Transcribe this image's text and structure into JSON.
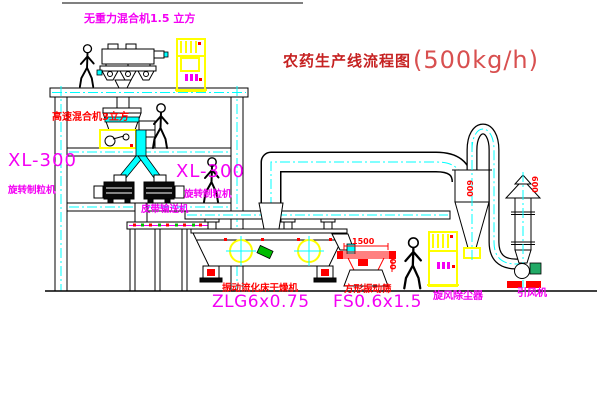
{
  "title": {
    "name": "农药生产线流程图",
    "capacity": "(500kg/h)"
  },
  "equipment_labels": {
    "gravity_free_mixer": "无重力混合机1.5 立方",
    "high_speed_mixer": "高速混合机3立方",
    "granulator_left_model": "XL-300",
    "granulator_left_name": "旋转制粒机",
    "granulator_right_model": "XL-300",
    "granulator_right_name": "旋转制粒机",
    "belt_conveyor": "皮带输送机",
    "fluid_bed_dryer_name": "振动流化床干燥机",
    "fluid_bed_dryer_model": "ZLG6x0.75",
    "square_sieve_name": "方形振动筛",
    "square_sieve_model": "FS0.6x1.5",
    "cyclone_dust_collector": "旋风除尘器",
    "induced_draft_fan": "引风机"
  },
  "dimensions": {
    "sieve_width": "1500",
    "sieve_height": "600",
    "cyclone_diameter": "600",
    "stack_diameter": "600"
  },
  "colors": {
    "label_magenta": "#f400f4",
    "label_red": "#ff0000",
    "centerline_cyan": "#00ffff",
    "highlight_yellow": "#ffff00",
    "line_black": "#000000"
  }
}
